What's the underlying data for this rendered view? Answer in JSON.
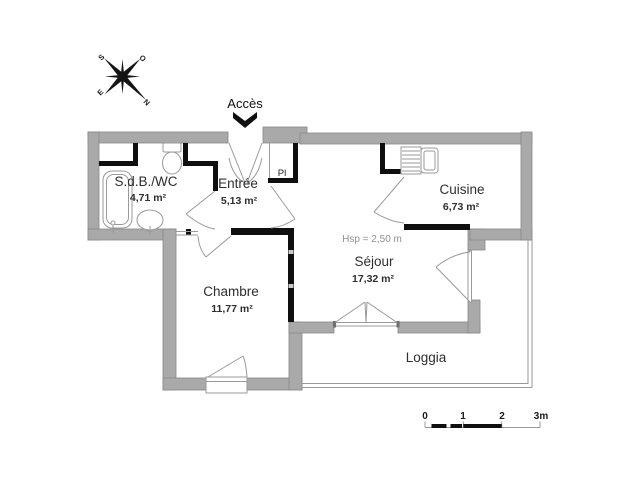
{
  "plan": {
    "access_label": "Accès",
    "closet_label": "Pl",
    "rooms": {
      "sdb": {
        "name": "S.d.B./WC",
        "area": "4,71 m²"
      },
      "entree": {
        "name": "Entrée",
        "area": "5,13 m²"
      },
      "cuisine": {
        "name": "Cuisine",
        "area": "6,73 m²"
      },
      "chambre": {
        "name": "Chambre",
        "area": "11,77 m²"
      },
      "sejour": {
        "name": "Séjour",
        "area": "17,32 m²",
        "ceiling_height": "Hsp = 2,50 m"
      },
      "loggia": {
        "name": "Loggia"
      }
    },
    "compass": {
      "north": "N",
      "south": "S",
      "east": "E",
      "west": "O"
    },
    "scale_bar": {
      "t0": "0",
      "t1": "1",
      "t2": "2",
      "t3": "3m"
    },
    "colors": {
      "wall_gray": "#a9a9a9",
      "wall_black": "#0f0f0f",
      "thin_line": "#9a9a9a",
      "text": "#2e2e2e",
      "muted_text": "#8f8f8f",
      "background": "#ffffff"
    }
  }
}
